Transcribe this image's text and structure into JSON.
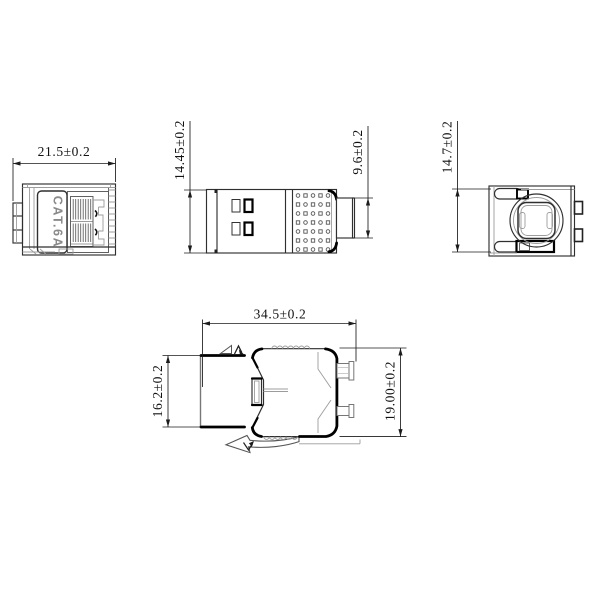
{
  "drawing": {
    "product_label": "CAT.6A",
    "dims": {
      "front_width": "21.5±0.2",
      "side_height": "14.45±0.2",
      "side_plug_height": "9.6±0.2",
      "rear_height": "14.7±0.2",
      "top_depth": "34.5±0.2",
      "top_body_height": "16.2±0.2",
      "top_overall_height": "19.00±0.2"
    },
    "colors": {
      "line": "#2f2f2f",
      "thick_line": "#000000",
      "light_line": "#9c9c9c",
      "background": "#ffffff",
      "label_text": "#8a8a8a"
    }
  }
}
